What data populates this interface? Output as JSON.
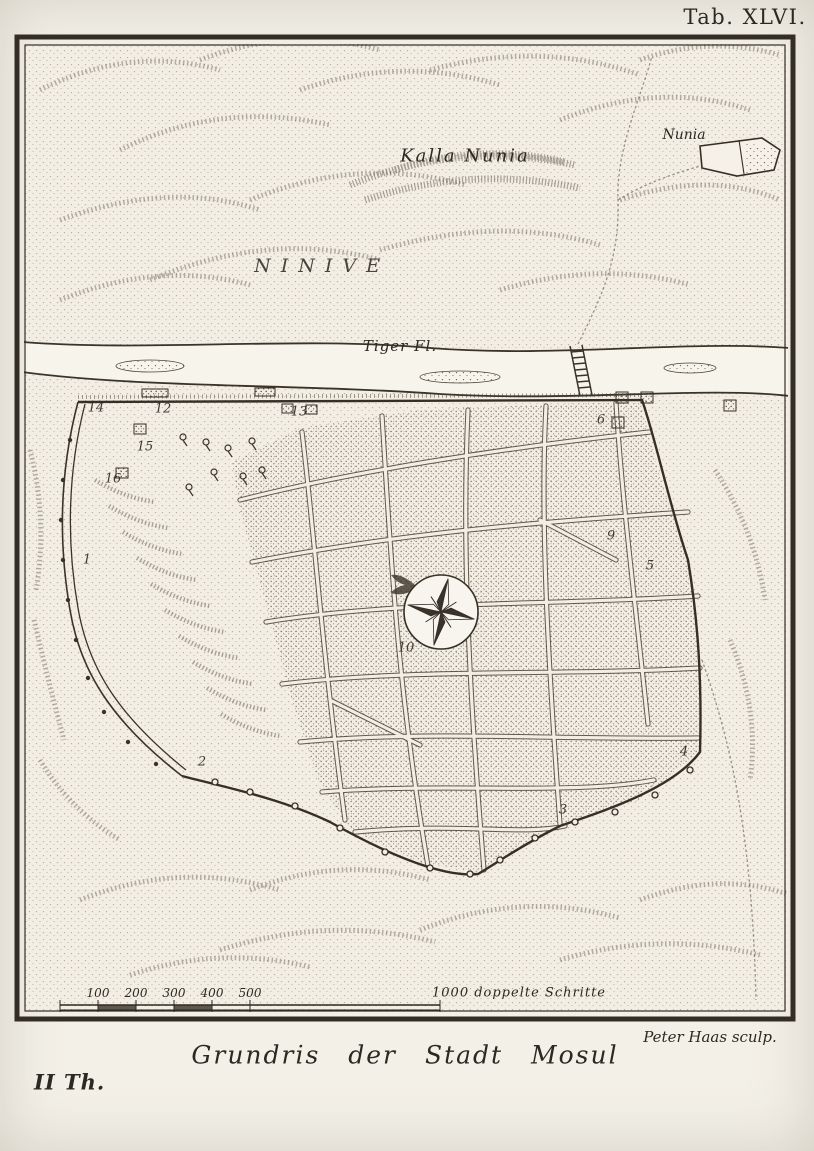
{
  "page": {
    "tab_label": "Tab. XLVI.",
    "map_title": "Grundris der Stadt Mosul",
    "engraver_credit": "Peter Haas sculp.",
    "volume_label": "II Th."
  },
  "map": {
    "place_labels": {
      "region": "NINIVE",
      "ruin_site": "Kalla Nunia",
      "village": "Nunia",
      "river": "Tiger Fl."
    },
    "markers": {
      "n1": "1",
      "n2": "2",
      "n3": "3",
      "n4": "4",
      "n5": "5",
      "n6": "6",
      "n9": "9",
      "n10": "10",
      "n12": "12",
      "n13": "13",
      "n14": "14",
      "n15": "15",
      "n16": "16"
    },
    "scale_bar": {
      "tick_labels": [
        "100",
        "200",
        "300",
        "400",
        "500"
      ],
      "end_label": "1000 doppelte Schritte"
    }
  },
  "colors": {
    "ink": "#2c2822",
    "paper": "#f3f0e8",
    "stipple": "#6f6557"
  }
}
